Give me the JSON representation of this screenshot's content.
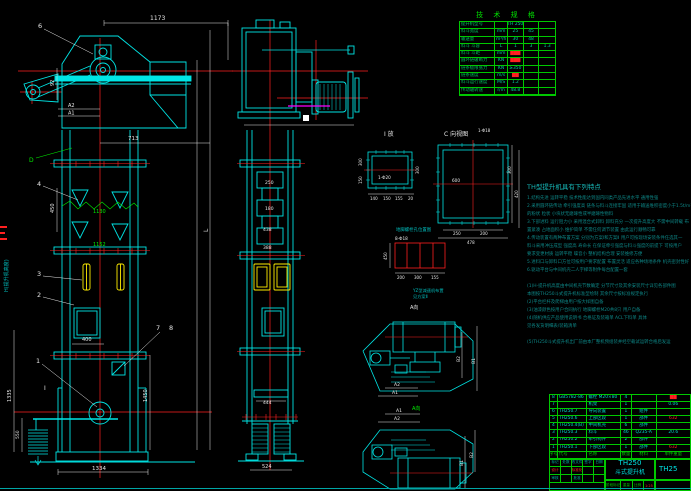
{
  "tech_table": {
    "title": "技 术 规 格",
    "rows": [
      [
        "提升机型号",
        "",
        "TH 250",
        "",
        ""
      ],
      [
        "料斗宽度",
        "mm",
        "25",
        "45",
        ""
      ],
      [
        "输送量",
        "m³/h",
        "30",
        "48",
        ""
      ],
      [
        "料斗 斗容",
        "L",
        "1",
        "3",
        "1.3"
      ],
      [
        "料斗 斗距",
        "mm",
        "███",
        "",
        ""
      ],
      [
        "圆环链破断力",
        "KN",
        "███",
        "",
        ""
      ],
      [
        "链条极限张力",
        "KN",
        "≥350",
        "",
        ""
      ],
      [
        "链条速度",
        "m/s",
        "██",
        "",
        ""
      ],
      [
        "料斗运行速度",
        "M/S",
        "1.2",
        "",
        ""
      ],
      [
        "传动轴转速",
        "r/m",
        "48.8",
        "",
        ""
      ]
    ]
  },
  "bom": {
    "rows": [
      [
        "8",
        "GB5782-86",
        "螺栓 M20×80",
        "4",
        "",
        "██"
      ],
      [
        "7",
        "",
        "机架",
        "1",
        "",
        "0.06"
      ],
      [
        "6",
        "TH250.7",
        "导向装置",
        "1",
        "组件",
        ""
      ],
      [
        "5",
        "TH250.6",
        "上部区段",
        "1",
        "部件",
        "632"
      ],
      [
        "4",
        "TH250.4(B)",
        "中间机壳",
        "6",
        "部件",
        ""
      ],
      [
        "3",
        "TH250.3",
        "料斗",
        "46",
        "Q235-A",
        "20.6"
      ],
      [
        "2",
        "TH250.2",
        "牵引构件",
        "2",
        "部件",
        ""
      ],
      [
        "1",
        "TH250.1",
        "下部区段",
        "1",
        "部件",
        "632"
      ]
    ],
    "header": [
      "序号",
      "代号",
      "名称",
      "数量",
      "材料",
      "单件重量"
    ]
  },
  "title_block": {
    "model": "TH250",
    "name": "斗式提升机",
    "doc_no": "TH25",
    "strip": [
      "阶段标记",
      "重量",
      "比例"
    ],
    "scale": "1:25",
    "row_marks": [
      "标记",
      "处数",
      "更改文件号",
      "签字",
      "日期"
    ],
    "row_design": [
      "设计",
      "",
      "标准化",
      "",
      ""
    ],
    "row_check": [
      "审核",
      "",
      "批准",
      "",
      ""
    ]
  },
  "features": {
    "title": "TH型提升机具有下列特点",
    "lines": [
      "1.结构先进 运转平稳 技术性能达到国内同类产品先进水平 通用性强",
      "2.采用圆环链传动 牵引强度高 链条与料斗连接牢固 适用于输送堆积密度小于1.5t/m³",
      "   的粉状 粒状 小块状无磨琢性或半磨琢性物料",
      "3.下部进料 运行阻力小 采用混合式卸料 卸料充分 一次提升高度大 不需中间转载 布",
      "   置紧凑 占地面积小 维护简单 不需任何调节装置 由此运行顺畅可靠",
      "4.传动装置有两种布置方案 分别为方案Ⅰ和方案Ⅱ 用户可按现场安装条件任选其一",
      "   料斗采用冲压成型 强度高 寿命长 在保证牵引强度与料斗强度的前提下 可按用户",
      "   要求变更材质 运转平稳 噪音小 整机结构合理 安装维修方便",
      "5.进料口与卸料口方位可按用户要求配置 布置灵活 适应各种场地条件 机壳密封性好",
      "6.驱动平台与中间机壳二人字梯等附件每台配置一套",
      "",
      "(1)H-提升机高度由中间机壳节数确定 分节尺寸及其余安装尺寸详见各部件图",
      "   本图按TH250斗式提升机标准型绘制 其余尺寸按标准规定执行",
      "(2)平台栏杆及爬梯由用户按大样图自备",
      "(3)油漆颜色按用户合同执行 地脚螺栓M20共8只 用户自备",
      "(4)随机供应产品使用说明书 合格证及装箱单 ACL下料单 具体",
      "   见各发货明细表/装箱清单",
      "",
      "(5)TH250斗式提升机出厂前由本厂整机预组装并经空载试运转合格后发运"
    ]
  },
  "left_view": {
    "labels": {
      "n6": "6",
      "n4": "4",
      "n3": "3",
      "n2": "2",
      "n1": "1",
      "n7": "7",
      "n8": "8",
      "d": "D",
      "i": "I"
    },
    "dims": {
      "top": "1173",
      "w713": "713",
      "g1130": "1130",
      "g1152": "1152",
      "v450": "450",
      "v92": "92",
      "a1": "A1",
      "a2": "A2",
      "l": "L",
      "h": "H(提升机高度)",
      "door": "400",
      "v1335": "1335",
      "v550": "550",
      "v1450": "1450",
      "base": "1334"
    }
  },
  "middle_view": {
    "dims": {
      "c1": "250",
      "c2": "180",
      "c3": "438",
      "c4": "388",
      "p": "444",
      "base": "524"
    }
  },
  "details": {
    "detail_i": {
      "label": "I 放",
      "hole": "1-Φ20",
      "b1": "140",
      "b2": "150",
      "b3": "155",
      "b4": "20",
      "l1": "300",
      "l2": "150",
      "r1": "300"
    },
    "view_c": {
      "label": "C 向视图",
      "hole": "1-Φ18",
      "center": "600",
      "b1": "250",
      "b2": "200",
      "b3": "478",
      "r1": "300",
      "r2": "420"
    },
    "bolt_plan": {
      "title": "地脚螺栓孔位置图",
      "hole": "8-Φ18",
      "left": "450",
      "b1": "200",
      "b2": "300",
      "b3": "155",
      "note1": "YZ型减速机布置",
      "note2": "见方案Ⅱ",
      "view": "A向"
    },
    "arr_top": {
      "a1": "A1",
      "a2": "A2",
      "b1": "B1",
      "b2": "B2",
      "view": "A向"
    },
    "arr_bottom": {
      "a1": "A1",
      "a2": "A2",
      "b1": "B1",
      "b2": "B2"
    }
  }
}
